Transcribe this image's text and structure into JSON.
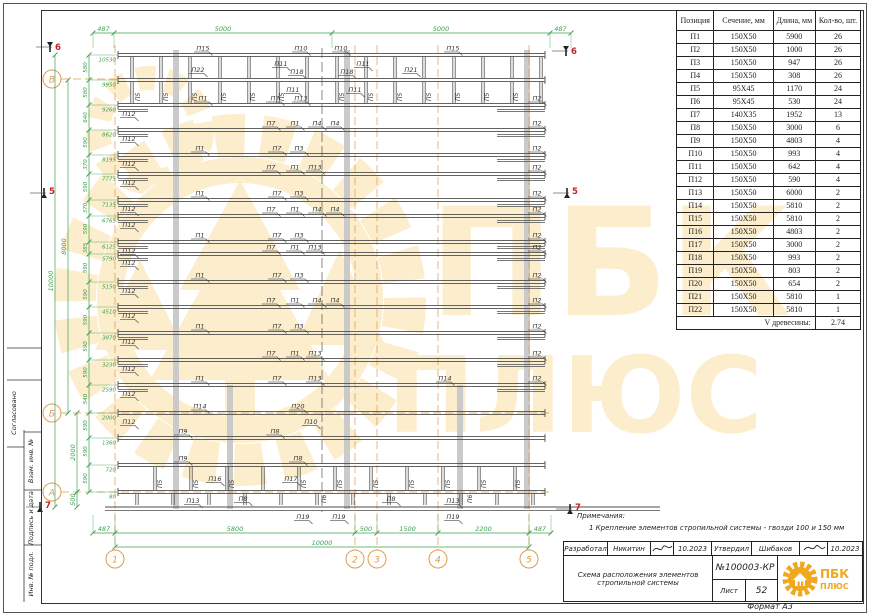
{
  "page": {
    "format_label": "Формат А3"
  },
  "frame": {
    "side_stamps": [
      "Согласовано",
      "Взам. инв. №",
      "Подпись и дата",
      "Инв. № подл."
    ]
  },
  "table": {
    "headers": [
      "Позиция",
      "Сечение, мм",
      "Длина, мм",
      "Кол-во, шт."
    ],
    "rows": [
      [
        "П1",
        "150X50",
        "5900",
        "26"
      ],
      [
        "П2",
        "150X50",
        "1000",
        "26"
      ],
      [
        "П3",
        "150X50",
        "947",
        "26"
      ],
      [
        "П4",
        "150X50",
        "308",
        "26"
      ],
      [
        "П5",
        "95X45",
        "1170",
        "24"
      ],
      [
        "П6",
        "95X45",
        "530",
        "24"
      ],
      [
        "П7",
        "140X35",
        "1952",
        "13"
      ],
      [
        "П8",
        "150X50",
        "3000",
        "6"
      ],
      [
        "П9",
        "150X50",
        "4803",
        "4"
      ],
      [
        "П10",
        "150X50",
        "993",
        "4"
      ],
      [
        "П11",
        "150X50",
        "642",
        "4"
      ],
      [
        "П12",
        "150X50",
        "590",
        "4"
      ],
      [
        "П13",
        "150X50",
        "6000",
        "2"
      ],
      [
        "П14",
        "150X50",
        "5810",
        "2"
      ],
      [
        "П15",
        "150X50",
        "5810",
        "2"
      ],
      [
        "П16",
        "150X50",
        "4803",
        "2"
      ],
      [
        "П17",
        "150X50",
        "3000",
        "2"
      ],
      [
        "П18",
        "150X50",
        "993",
        "2"
      ],
      [
        "П19",
        "150X50",
        "803",
        "2"
      ],
      [
        "П20",
        "150X50",
        "654",
        "2"
      ],
      [
        "П21",
        "150X50",
        "5810",
        "1"
      ],
      [
        "П22",
        "150X50",
        "5810",
        "1"
      ]
    ],
    "footer_label": "V древесины:",
    "footer_value": "2.74"
  },
  "notes": {
    "header": "Примечания:",
    "item": "1     Крепление элементов стропильной системы - гвозди 100 и 150 мм"
  },
  "title_block": {
    "developed_label": "Разработал",
    "developed_name": "Никитин",
    "date1": "10.2023",
    "approved_label": "Утвердил",
    "approved_name": "Шибаков",
    "date2": "10.2023",
    "doc_title_line1": "Схема расположения элементов",
    "doc_title_line2": "стропильной системы",
    "doc_number": "№100003-КР",
    "sheet_label": "Лист",
    "sheet_number": "52"
  },
  "logo": {
    "name1": "ПБК",
    "name2": "ПЛЮС",
    "color": "#f0a81e"
  },
  "watermark": {
    "text1": "ПБК",
    "text2": "ПЛЮС",
    "color": "#f2b01e"
  },
  "drawing": {
    "colors": {
      "dim": "#3f9f4f",
      "axis": "#dd9c4c",
      "line": "#4d4d4d",
      "red": "#c22222",
      "band": "#cacaca"
    },
    "extent": {
      "x1": 118,
      "x2": 545,
      "top": 53,
      "bottom": 507,
      "eave_x1": 105,
      "eave_x2": 660
    },
    "ridge_x": 322,
    "top_dim": {
      "y": 33,
      "ticks": [
        93,
        114,
        332,
        550,
        571
      ],
      "labels": [
        "487",
        "5000",
        "5000",
        "487"
      ]
    },
    "bottom_dim1": {
      "y": 533,
      "ticks": [
        93,
        115,
        355,
        377,
        438,
        529,
        551
      ],
      "labels": [
        "487",
        "5800",
        "500",
        "1500",
        "2200",
        "487"
      ]
    },
    "bottom_dim2": {
      "y": 547,
      "ticks": [
        115,
        529
      ],
      "labels": [
        "10000"
      ]
    },
    "left_dim_x": 89,
    "segment_dims": [
      "580",
      "580",
      "640",
      "590",
      "370",
      "590",
      "370",
      "590",
      "385",
      "590",
      "590",
      "590",
      "590",
      "590",
      "540",
      "590",
      "590",
      "590"
    ],
    "overall_dims": [
      {
        "x": 55,
        "y1": 55,
        "y2": 507,
        "label": "10000"
      },
      {
        "x": 68,
        "y1": 80,
        "y2": 413,
        "label": "8000"
      },
      {
        "x": 77,
        "y1": 413,
        "y2": 492,
        "label": "2000"
      },
      {
        "x": 77,
        "y1": 492,
        "y2": 507,
        "label": "500"
      }
    ],
    "axes_bottom": [
      {
        "x": 115,
        "label": "1"
      },
      {
        "x": 355,
        "label": "2"
      },
      {
        "x": 377,
        "label": "3"
      },
      {
        "x": 438,
        "label": "4"
      },
      {
        "x": 529,
        "label": "5"
      }
    ],
    "axes_left": [
      {
        "y": 79,
        "label": "В"
      },
      {
        "y": 413,
        "label": "Б"
      },
      {
        "y": 492,
        "label": "А"
      }
    ],
    "sections": [
      {
        "x": 50,
        "y": 44,
        "label": "6",
        "dir": "down"
      },
      {
        "x": 566,
        "y": 48,
        "label": "6",
        "dir": "down"
      },
      {
        "x": 44,
        "y": 196,
        "label": "5",
        "dir": "up"
      },
      {
        "x": 567,
        "y": 196,
        "label": "5",
        "dir": "up"
      },
      {
        "x": 40,
        "y": 510,
        "label": "7",
        "dir": "up"
      },
      {
        "x": 570,
        "y": 512,
        "label": "7",
        "dir": "up"
      }
    ],
    "purlins": [
      {
        "x": 176,
        "y1": 50,
        "y2": 509
      },
      {
        "x": 347,
        "y1": 50,
        "y2": 509
      },
      {
        "x": 527,
        "y1": 50,
        "y2": 509
      },
      {
        "x": 230,
        "y1": 385,
        "y2": 509
      },
      {
        "x": 460,
        "y1": 385,
        "y2": 509
      }
    ],
    "rows": [
      {
        "y": 55,
        "elev": "10530",
        "labels": [
          {
            "t": "П15",
            "x": 198
          },
          {
            "t": "П10",
            "x": 296
          },
          {
            "t": "П10",
            "x": 336
          },
          {
            "t": "П15",
            "x": 448
          }
        ]
      },
      {
        "y": 80,
        "elev": "9950",
        "labels": []
      },
      {
        "y": 105,
        "elev": "9260",
        "stub": true,
        "labels": [
          {
            "t": "П12",
            "x": 124,
            "pos": "below"
          },
          {
            "t": "П1",
            "x": 198
          },
          {
            "t": "П7",
            "x": 270
          },
          {
            "t": "П13",
            "x": 296
          },
          {
            "t": "П2",
            "x": 532
          }
        ]
      },
      {
        "y": 130,
        "elev": "8620",
        "stub": true,
        "labels": [
          {
            "t": "П12",
            "x": 124,
            "pos": "below"
          },
          {
            "t": "П1",
            "x": 290
          },
          {
            "t": "П7",
            "x": 266
          },
          {
            "t": "П4",
            "x": 312
          },
          {
            "t": "П4",
            "x": 330
          },
          {
            "t": "П2",
            "x": 532
          }
        ]
      },
      {
        "y": 155,
        "elev": "8195",
        "stub": true,
        "labels": [
          {
            "t": "П12",
            "x": 124,
            "pos": "below"
          },
          {
            "t": "П1",
            "x": 195
          },
          {
            "t": "П7",
            "x": 272
          },
          {
            "t": "П3",
            "x": 294
          },
          {
            "t": "П2",
            "x": 532
          }
        ]
      },
      {
        "y": 174,
        "elev": "7775",
        "stub": true,
        "labels": [
          {
            "t": "П12",
            "x": 124,
            "pos": "below"
          },
          {
            "t": "П1",
            "x": 290
          },
          {
            "t": "П7",
            "x": 266
          },
          {
            "t": "П13",
            "x": 310
          },
          {
            "t": "П2",
            "x": 532
          }
        ]
      },
      {
        "y": 200,
        "elev": "7135",
        "stub": true,
        "labels": [
          {
            "t": "П12",
            "x": 124,
            "pos": "below"
          },
          {
            "t": "П1",
            "x": 195
          },
          {
            "t": "П7",
            "x": 272
          },
          {
            "t": "П3",
            "x": 294
          },
          {
            "t": "П2",
            "x": 532
          }
        ]
      },
      {
        "y": 216,
        "elev": "6765",
        "stub": true,
        "labels": [
          {
            "t": "П12",
            "x": 124,
            "pos": "below"
          },
          {
            "t": "П1",
            "x": 290
          },
          {
            "t": "П7",
            "x": 266
          },
          {
            "t": "П4",
            "x": 312
          },
          {
            "t": "П4",
            "x": 330
          },
          {
            "t": "П2",
            "x": 532
          }
        ]
      },
      {
        "y": 242,
        "elev": "6125",
        "stub": true,
        "labels": [
          {
            "t": "П12",
            "x": 124,
            "pos": "below"
          },
          {
            "t": "П1",
            "x": 195
          },
          {
            "t": "П7",
            "x": 272
          },
          {
            "t": "П3",
            "x": 294
          },
          {
            "t": "П2",
            "x": 532
          }
        ]
      },
      {
        "y": 254,
        "elev": "5790",
        "stub": true,
        "labels": [
          {
            "t": "П12",
            "x": 124,
            "pos": "below"
          },
          {
            "t": "П1",
            "x": 290
          },
          {
            "t": "П7",
            "x": 266
          },
          {
            "t": "П13",
            "x": 310
          },
          {
            "t": "П2",
            "x": 532
          }
        ]
      },
      {
        "y": 282,
        "elev": "5150",
        "stub": true,
        "labels": [
          {
            "t": "П12",
            "x": 124,
            "pos": "below"
          },
          {
            "t": "П1",
            "x": 195
          },
          {
            "t": "П7",
            "x": 272
          },
          {
            "t": "П3",
            "x": 294
          },
          {
            "t": "П2",
            "x": 532
          }
        ]
      },
      {
        "y": 307,
        "elev": "4510",
        "stub": true,
        "labels": [
          {
            "t": "П12",
            "x": 124,
            "pos": "below"
          },
          {
            "t": "П1",
            "x": 290
          },
          {
            "t": "П7",
            "x": 266
          },
          {
            "t": "П4",
            "x": 312
          },
          {
            "t": "П4",
            "x": 330
          },
          {
            "t": "П2",
            "x": 532
          }
        ]
      },
      {
        "y": 333,
        "elev": "3870",
        "stub": true,
        "labels": [
          {
            "t": "П12",
            "x": 124,
            "pos": "below"
          },
          {
            "t": "П1",
            "x": 195
          },
          {
            "t": "П7",
            "x": 272
          },
          {
            "t": "П3",
            "x": 294
          },
          {
            "t": "П2",
            "x": 532
          }
        ]
      },
      {
        "y": 360,
        "elev": "3230",
        "stub": true,
        "labels": [
          {
            "t": "П12",
            "x": 124,
            "pos": "below"
          },
          {
            "t": "П1",
            "x": 290
          },
          {
            "t": "П7",
            "x": 266
          },
          {
            "t": "П13",
            "x": 310
          },
          {
            "t": "П2",
            "x": 532
          }
        ]
      },
      {
        "y": 385,
        "elev": "2590",
        "stub": true,
        "labels": [
          {
            "t": "П12",
            "x": 124,
            "pos": "below"
          },
          {
            "t": "П1",
            "x": 195
          },
          {
            "t": "П7",
            "x": 272
          },
          {
            "t": "П13",
            "x": 310
          },
          {
            "t": "П14",
            "x": 440
          },
          {
            "t": "П2",
            "x": 532
          }
        ]
      },
      {
        "y": 413,
        "elev": "2000",
        "labels": [
          {
            "t": "П14",
            "x": 195
          },
          {
            "t": "П20",
            "x": 293
          },
          {
            "t": "П10",
            "x": 306,
            "pos": "below"
          },
          {
            "t": "П12",
            "x": 124,
            "pos": "below"
          }
        ]
      },
      {
        "y": 438,
        "elev": "1360",
        "labels": [
          {
            "t": "П9",
            "x": 178
          },
          {
            "t": "П8",
            "x": 270
          }
        ]
      },
      {
        "y": 465,
        "elev": "720",
        "labels": [
          {
            "t": "П9",
            "x": 178
          },
          {
            "t": "П8",
            "x": 293
          }
        ]
      },
      {
        "y": 492,
        "elev": "80",
        "labels": []
      }
    ],
    "eave_labels": [
      {
        "t": "П19",
        "x": 298
      },
      {
        "t": "П19",
        "x": 334
      },
      {
        "t": "П19",
        "x": 448
      }
    ],
    "bands": [
      {
        "y1": 55,
        "y2": 80,
        "xs": [
          132,
          161,
          190,
          220,
          249,
          278,
          307,
          337,
          366,
          395,
          424,
          454,
          483,
          512,
          541
        ],
        "labels": [
          {
            "t": "П22",
            "x": 193,
            "y": 72
          },
          {
            "t": "П11",
            "x": 276,
            "y": 66
          },
          {
            "t": "П18",
            "x": 292,
            "y": 74
          },
          {
            "t": "П18",
            "x": 342,
            "y": 74
          },
          {
            "t": "П11",
            "x": 358,
            "y": 66
          },
          {
            "t": "П21",
            "x": 406,
            "y": 72
          }
        ]
      },
      {
        "y1": 80,
        "y2": 105,
        "xs": [
          132,
          161,
          190,
          220,
          249,
          278,
          307,
          337,
          366,
          395,
          424,
          454,
          483,
          512,
          541
        ],
        "rot_label": "П5",
        "rot_xs": [
          140,
          168,
          197,
          226,
          255,
          284,
          344,
          373,
          402,
          431,
          460,
          489,
          518
        ],
        "labels": [
          {
            "t": "П11",
            "x": 288,
            "y": 92
          },
          {
            "t": "П11",
            "x": 350,
            "y": 92
          }
        ]
      },
      {
        "y1": 465,
        "y2": 492,
        "xs": [
          155,
          191,
          227,
          263,
          299,
          335,
          371,
          407,
          443,
          479,
          515
        ],
        "rot_label": "П5",
        "rot_xs": [
          162,
          198,
          234,
          306,
          342,
          378,
          414,
          450,
          486,
          520
        ],
        "labels": [
          {
            "t": "П16",
            "x": 210,
            "y": 481
          },
          {
            "t": "П17",
            "x": 286,
            "y": 481
          }
        ]
      },
      {
        "y1": 492,
        "y2": 507,
        "xs": [
          137,
          173,
          209,
          245,
          281,
          317,
          353,
          389,
          425,
          461,
          497,
          533
        ],
        "rot_label": "П6",
        "rot_xs": [
          326,
          472
        ],
        "labels": [
          {
            "t": "П13",
            "x": 188,
            "y": 503
          },
          {
            "t": "П8",
            "x": 238,
            "y": 501
          },
          {
            "t": "П8",
            "x": 386,
            "y": 501
          },
          {
            "t": "П13",
            "x": 448,
            "y": 503
          }
        ]
      }
    ]
  }
}
